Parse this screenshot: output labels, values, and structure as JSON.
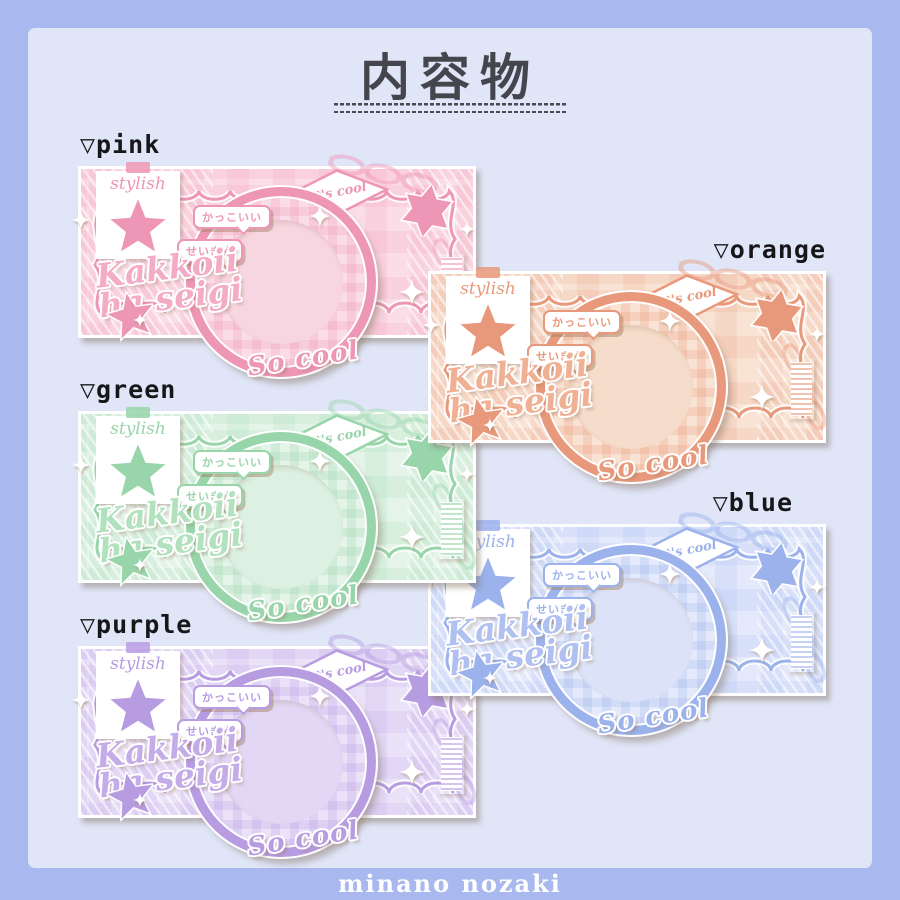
{
  "page": {
    "title": "内容物",
    "credit": "minano nozaki",
    "background": "#a9b8ee",
    "panel": "#e0e6f8",
    "title_color": "#45454e"
  },
  "card_template": {
    "tag_label": "stylish",
    "banner_label": "It's cool",
    "bubble1": "かっこいい",
    "bubble2": "せいぎ☆",
    "script_line1": "Kakkoii",
    "script_line2": "ha seigi",
    "circle_label": "So cool"
  },
  "icons": {
    "variant-marker": "▽",
    "five-point-star": "★",
    "six-point-star": "✶",
    "sparkle": "✦"
  },
  "variants": [
    {
      "id": "pink",
      "label": "▽pink",
      "accent": "#ee96b5",
      "light": "#fbdde7",
      "inner": "#f8d6e1",
      "script": "#f4abc6"
    },
    {
      "id": "orange",
      "label": "▽orange",
      "accent": "#e9997b",
      "light": "#f9e3d4",
      "inner": "#f6dcca",
      "script": "#f0b093"
    },
    {
      "id": "green",
      "label": "▽green",
      "accent": "#98d5aa",
      "light": "#e4f4e8",
      "inner": "#dcf1e1",
      "script": "#b2e1be"
    },
    {
      "id": "blue",
      "label": "▽blue",
      "accent": "#9cb2ec",
      "light": "#e4eafb",
      "inner": "#dce3f9",
      "script": "#afc0f1"
    },
    {
      "id": "purple",
      "label": "▽purple",
      "accent": "#b79ce2",
      "light": "#eae2f8",
      "inner": "#e2d7f4",
      "script": "#c4ace9"
    }
  ]
}
